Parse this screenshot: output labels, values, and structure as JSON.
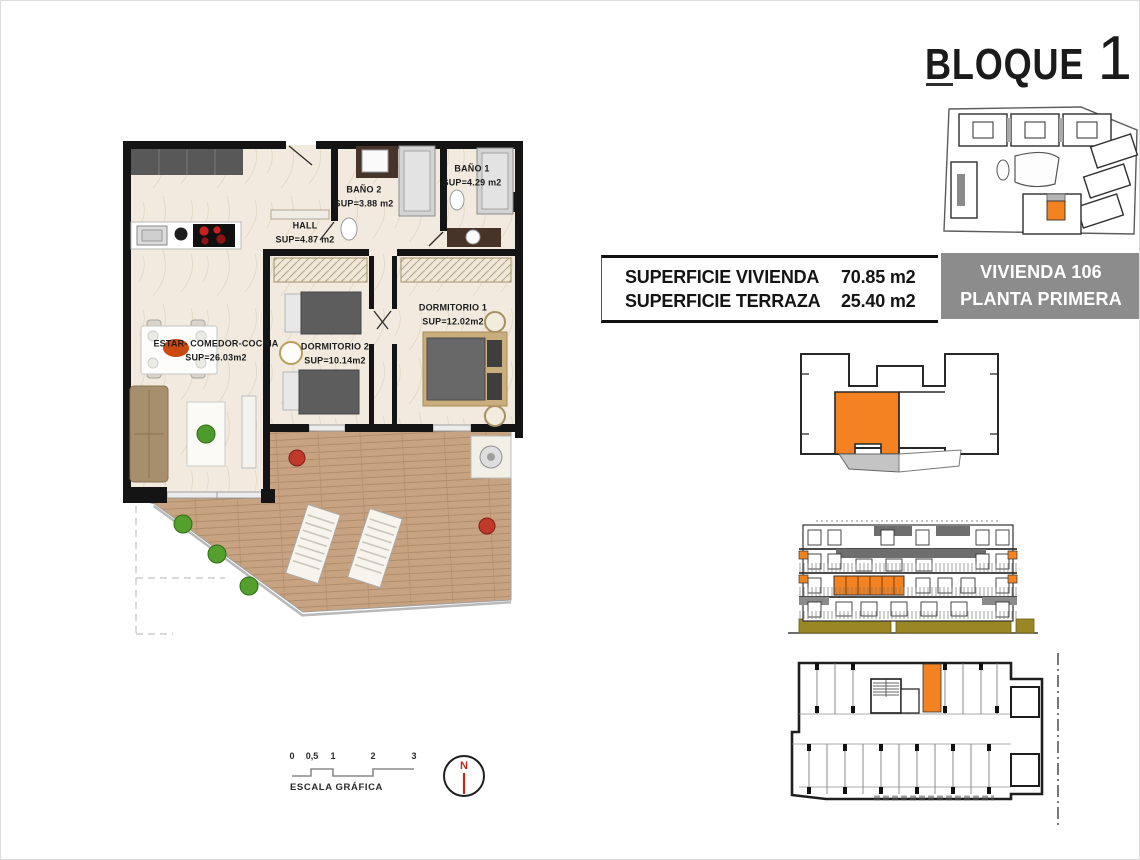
{
  "title": {
    "block": "BLOQUE",
    "number": "1"
  },
  "info_bar": {
    "rows": [
      {
        "label": "SUPERFICIE VIVIENDA",
        "value": "70.85 m2"
      },
      {
        "label": "SUPERFICIE TERRAZA",
        "value": "25.40 m2"
      }
    ],
    "unit": "VIVIENDA 106",
    "floor": "PLANTA PRIMERA"
  },
  "floor_plan": {
    "rooms": [
      {
        "name": "ESTAR-  COMEDOR-COCINA",
        "area": "SUP=26.03m2"
      },
      {
        "name": "DORMITORIO  2",
        "area": "SUP=10.14m2"
      },
      {
        "name": "DORMITORIO  1",
        "area": "SUP=12.02m2"
      },
      {
        "name": "HALL",
        "area": "SUP=4.87  m2"
      },
      {
        "name": "BAÑO  2",
        "area": "SUP=3.88  m2"
      },
      {
        "name": "BAÑO  1",
        "area": "SUP=4.29  m2"
      }
    ]
  },
  "scale_bar": {
    "ticks": [
      "0",
      "0,5",
      "1",
      "2",
      "3"
    ],
    "label": "ESCALA GRÁFICA"
  },
  "compass": {
    "north": "N"
  },
  "colors": {
    "highlight_orange": "#F58220",
    "panel_gray": "#8C8C8C",
    "terrace_wood": "#C7A382",
    "interior_cream": "#F2EADE",
    "wall_black": "#141414",
    "hedge_olive": "#9B8626",
    "compass_red": "#C0271D"
  }
}
